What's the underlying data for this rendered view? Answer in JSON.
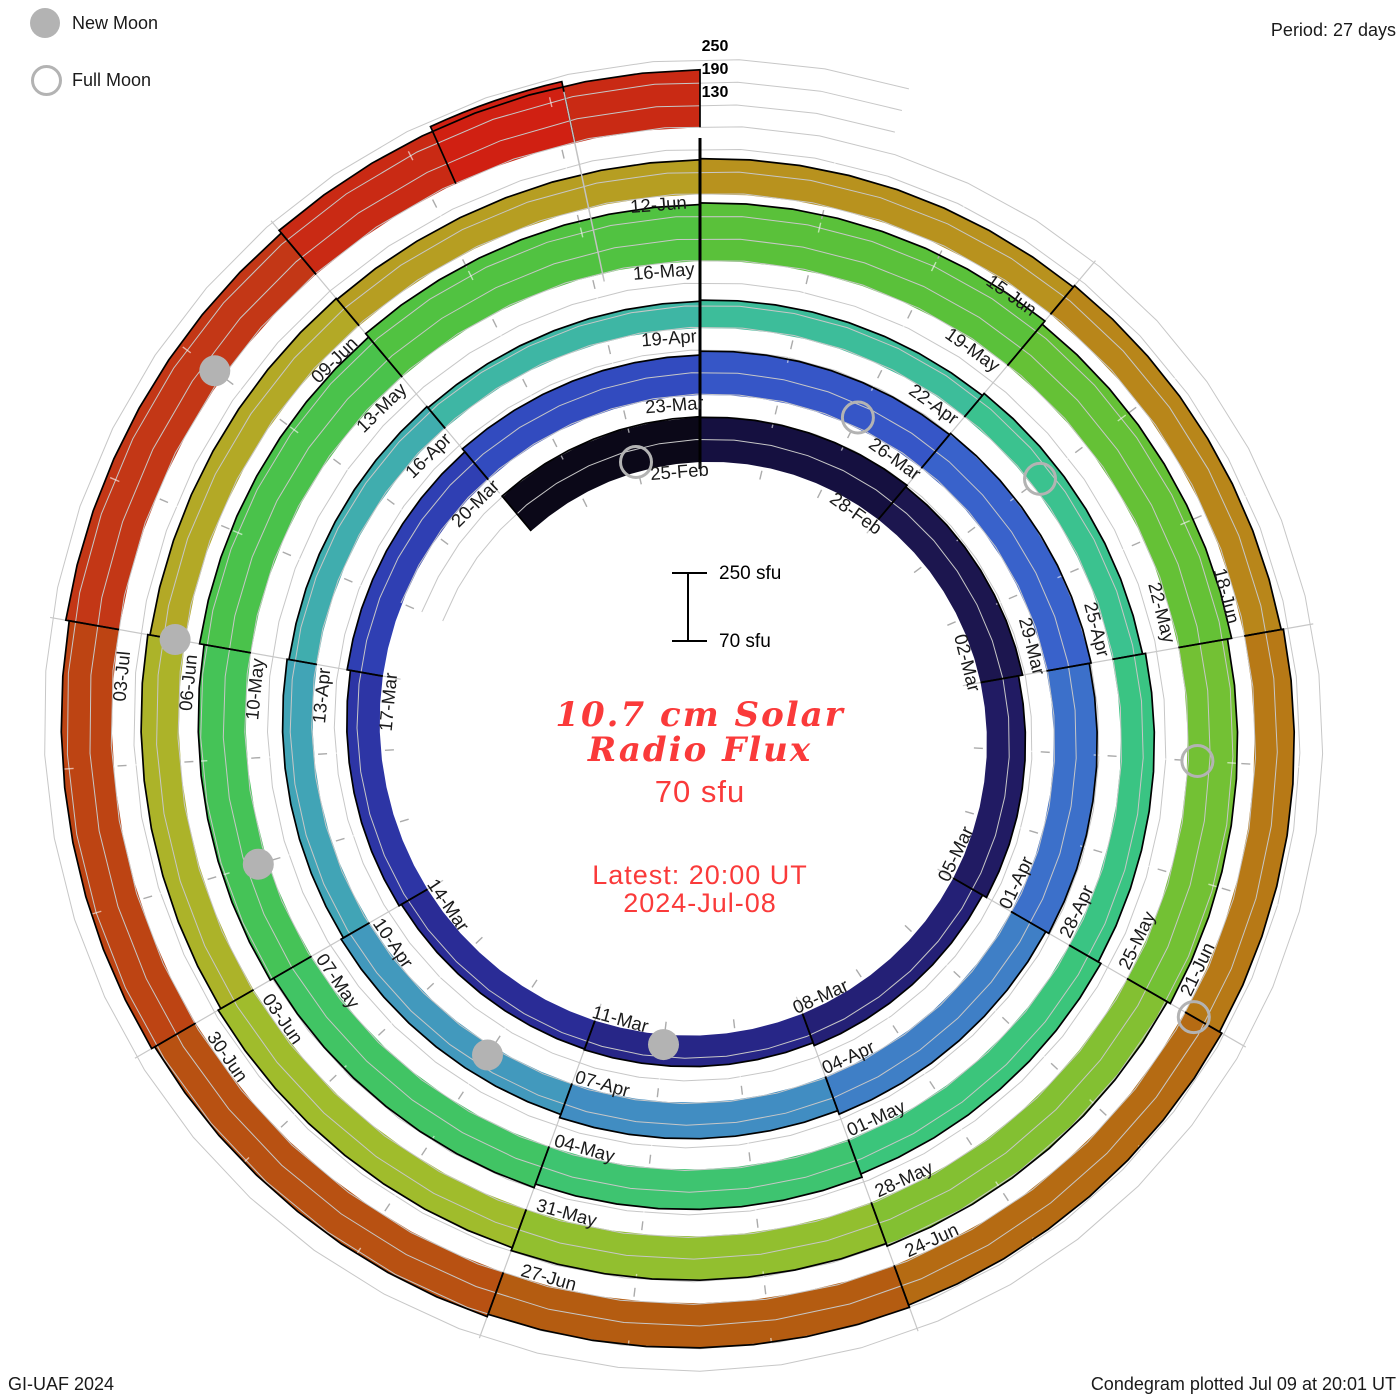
{
  "legend": {
    "new_moon_label": "New Moon",
    "full_moon_label": "Full Moon"
  },
  "period_label": "Period: 27 days",
  "radial_axis_labels": [
    "250",
    "190",
    "130"
  ],
  "scale_bar": {
    "top_label": "250 sfu",
    "bottom_label": "70 sfu"
  },
  "center": {
    "title_line1": "10.7 cm Solar",
    "title_line2": "Radio Flux",
    "baseline_flux": "70 sfu",
    "latest_line1": "Latest: 20:00 UT",
    "latest_line2": "2024-Jul-08"
  },
  "footer": {
    "left": "GI-UAF 2024",
    "right": "Condegram plotted Jul 09 at 20:01 UT"
  },
  "colors": {
    "grid": "#c7c7c7",
    "spoke": "#c7c7c7",
    "minor_tick": "#ababab",
    "band_tick": "#e8e8e8",
    "outline": "#000000",
    "moon_gray": "#b3b3b3",
    "date_label": "#1a1a1a",
    "accent_red": "#fa3a3a"
  },
  "chart_data": {
    "type": "spiral-bar-condegram",
    "title": "10.7 cm Solar Radio Flux",
    "period_days": 27,
    "days_per_segment": 3,
    "flux_baseline_sfu": 70,
    "flux_max_sfu": 250,
    "flux_gridlines_sfu": [
      130,
      190,
      250
    ],
    "start_date": "22-Feb-2024",
    "segments": [
      {
        "day": -3,
        "date": "22-Feb",
        "flux_sfu": 190,
        "color": "#0b0818",
        "label": false
      },
      {
        "day": 0,
        "date": "25-Feb",
        "flux_sfu": 188,
        "color": "#151040",
        "label": true
      },
      {
        "day": 3,
        "date": "28-Feb",
        "flux_sfu": 183,
        "color": "#1c164f",
        "label": true
      },
      {
        "day": 6,
        "date": "02-Mar",
        "flux_sfu": 172,
        "color": "#211b63",
        "label": true
      },
      {
        "day": 9,
        "date": "05-Mar",
        "flux_sfu": 160,
        "color": "#242076",
        "label": true
      },
      {
        "day": 12,
        "date": "08-Mar",
        "flux_sfu": 152,
        "color": "#272687",
        "label": true
      },
      {
        "day": 15,
        "date": "11-Mar",
        "flux_sfu": 150,
        "color": "#2a2c96",
        "label": true
      },
      {
        "day": 18,
        "date": "14-Mar",
        "flux_sfu": 157,
        "color": "#2d35a5",
        "label": true
      },
      {
        "day": 21,
        "date": "17-Mar",
        "flux_sfu": 166,
        "color": "#2f3fb3",
        "label": true
      },
      {
        "day": 24,
        "date": "20-Mar",
        "flux_sfu": 176,
        "color": "#324bbf",
        "label": true
      },
      {
        "day": 27,
        "date": "23-Mar",
        "flux_sfu": 186,
        "color": "#3656c7",
        "label": true
      },
      {
        "day": 30,
        "date": "26-Mar",
        "flux_sfu": 190,
        "color": "#3962cb",
        "label": true
      },
      {
        "day": 33,
        "date": "29-Mar",
        "flux_sfu": 185,
        "color": "#3c70ca",
        "label": true
      },
      {
        "day": 36,
        "date": "01-Apr",
        "flux_sfu": 176,
        "color": "#3f7fc6",
        "label": true
      },
      {
        "day": 39,
        "date": "04-Apr",
        "flux_sfu": 166,
        "color": "#418dc2",
        "label": true
      },
      {
        "day": 42,
        "date": "07-Apr",
        "flux_sfu": 157,
        "color": "#4299bd",
        "label": true
      },
      {
        "day": 45,
        "date": "10-Apr",
        "flux_sfu": 150,
        "color": "#41a4b6",
        "label": true
      },
      {
        "day": 48,
        "date": "13-Apr",
        "flux_sfu": 145,
        "color": "#40adae",
        "label": true
      },
      {
        "day": 51,
        "date": "16-Apr",
        "flux_sfu": 141,
        "color": "#3eb6a4",
        "label": true
      },
      {
        "day": 54,
        "date": "19-Apr",
        "flux_sfu": 144,
        "color": "#3dbd9a",
        "label": true
      },
      {
        "day": 57,
        "date": "22-Apr",
        "flux_sfu": 151,
        "color": "#3bc28f",
        "label": true
      },
      {
        "day": 60,
        "date": "25-Apr",
        "flux_sfu": 159,
        "color": "#3ac483",
        "label": true
      },
      {
        "day": 63,
        "date": "28-Apr",
        "flux_sfu": 167,
        "color": "#3bc57b",
        "label": true
      },
      {
        "day": 66,
        "date": "01-May",
        "flux_sfu": 176,
        "color": "#3ec470",
        "label": true
      },
      {
        "day": 69,
        "date": "04-May",
        "flux_sfu": 186,
        "color": "#41c464",
        "label": true
      },
      {
        "day": 72,
        "date": "07-May",
        "flux_sfu": 196,
        "color": "#45c357",
        "label": true
      },
      {
        "day": 75,
        "date": "10-May",
        "flux_sfu": 208,
        "color": "#4ac24b",
        "label": true
      },
      {
        "day": 78,
        "date": "13-May",
        "flux_sfu": 220,
        "color": "#51c241",
        "label": true
      },
      {
        "day": 81,
        "date": "16-May",
        "flux_sfu": 224,
        "color": "#5ac13a",
        "label": true
      },
      {
        "day": 84,
        "date": "19-May",
        "flux_sfu": 213,
        "color": "#65c136",
        "label": true
      },
      {
        "day": 87,
        "date": "22-May",
        "flux_sfu": 202,
        "color": "#73c134",
        "label": true
      },
      {
        "day": 90,
        "date": "25-May",
        "flux_sfu": 193,
        "color": "#83c032",
        "label": true
      },
      {
        "day": 93,
        "date": "28-May",
        "flux_sfu": 186,
        "color": "#92bf2f",
        "label": true
      },
      {
        "day": 96,
        "date": "31-May",
        "flux_sfu": 178,
        "color": "#a0bc2c",
        "label": true
      },
      {
        "day": 99,
        "date": "03-Jun",
        "flux_sfu": 170,
        "color": "#acb329",
        "label": true
      },
      {
        "day": 102,
        "date": "06-Jun",
        "flux_sfu": 164,
        "color": "#b3a926",
        "label": true
      },
      {
        "day": 105,
        "date": "09-Jun",
        "flux_sfu": 161,
        "color": "#b69e22",
        "label": true
      },
      {
        "day": 108,
        "date": "12-Jun",
        "flux_sfu": 164,
        "color": "#b8921e",
        "label": true
      },
      {
        "day": 111,
        "date": "15-Jun",
        "flux_sfu": 169,
        "color": "#b8861a",
        "label": true
      },
      {
        "day": 114,
        "date": "18-Jun",
        "flux_sfu": 175,
        "color": "#b77916",
        "label": true
      },
      {
        "day": 117,
        "date": "21-Jun",
        "flux_sfu": 182,
        "color": "#b56b13",
        "label": true
      },
      {
        "day": 120,
        "date": "24-Jun",
        "flux_sfu": 188,
        "color": "#b45c11",
        "label": true
      },
      {
        "day": 123,
        "date": "27-Jun",
        "flux_sfu": 195,
        "color": "#b85112",
        "label": true
      },
      {
        "day": 126,
        "date": "30-Jun",
        "flux_sfu": 204,
        "color": "#bd4413",
        "label": true
      },
      {
        "day": 129,
        "date": "03-Jul",
        "flux_sfu": 213,
        "color": "#c33716",
        "label": true
      },
      {
        "day": 132,
        "date": "06-Jul",
        "flux_sfu": 222,
        "color": "#c92a14",
        "label": false
      }
    ],
    "end_cap": {
      "date": "08-Jul",
      "day_start": 133.2,
      "day_end": 134.1,
      "flux_sfu": 235,
      "color": "#d02012"
    },
    "moon_events": [
      {
        "phase": "full",
        "date": "24-Feb",
        "day": -1
      },
      {
        "phase": "new",
        "date": "10-Mar",
        "day": 14
      },
      {
        "phase": "full",
        "date": "25-Mar",
        "day": 29
      },
      {
        "phase": "new",
        "date": "08-Apr",
        "day": 43
      },
      {
        "phase": "full",
        "date": "23-Apr",
        "day": 58
      },
      {
        "phase": "new",
        "date": "08-May",
        "day": 73
      },
      {
        "phase": "full",
        "date": "23-May",
        "day": 88
      },
      {
        "phase": "new",
        "date": "06-Jun",
        "day": 102
      },
      {
        "phase": "full",
        "date": "21-Jun",
        "day": 117
      },
      {
        "phase": "new",
        "date": "05-Jul",
        "day": 131
      }
    ]
  }
}
